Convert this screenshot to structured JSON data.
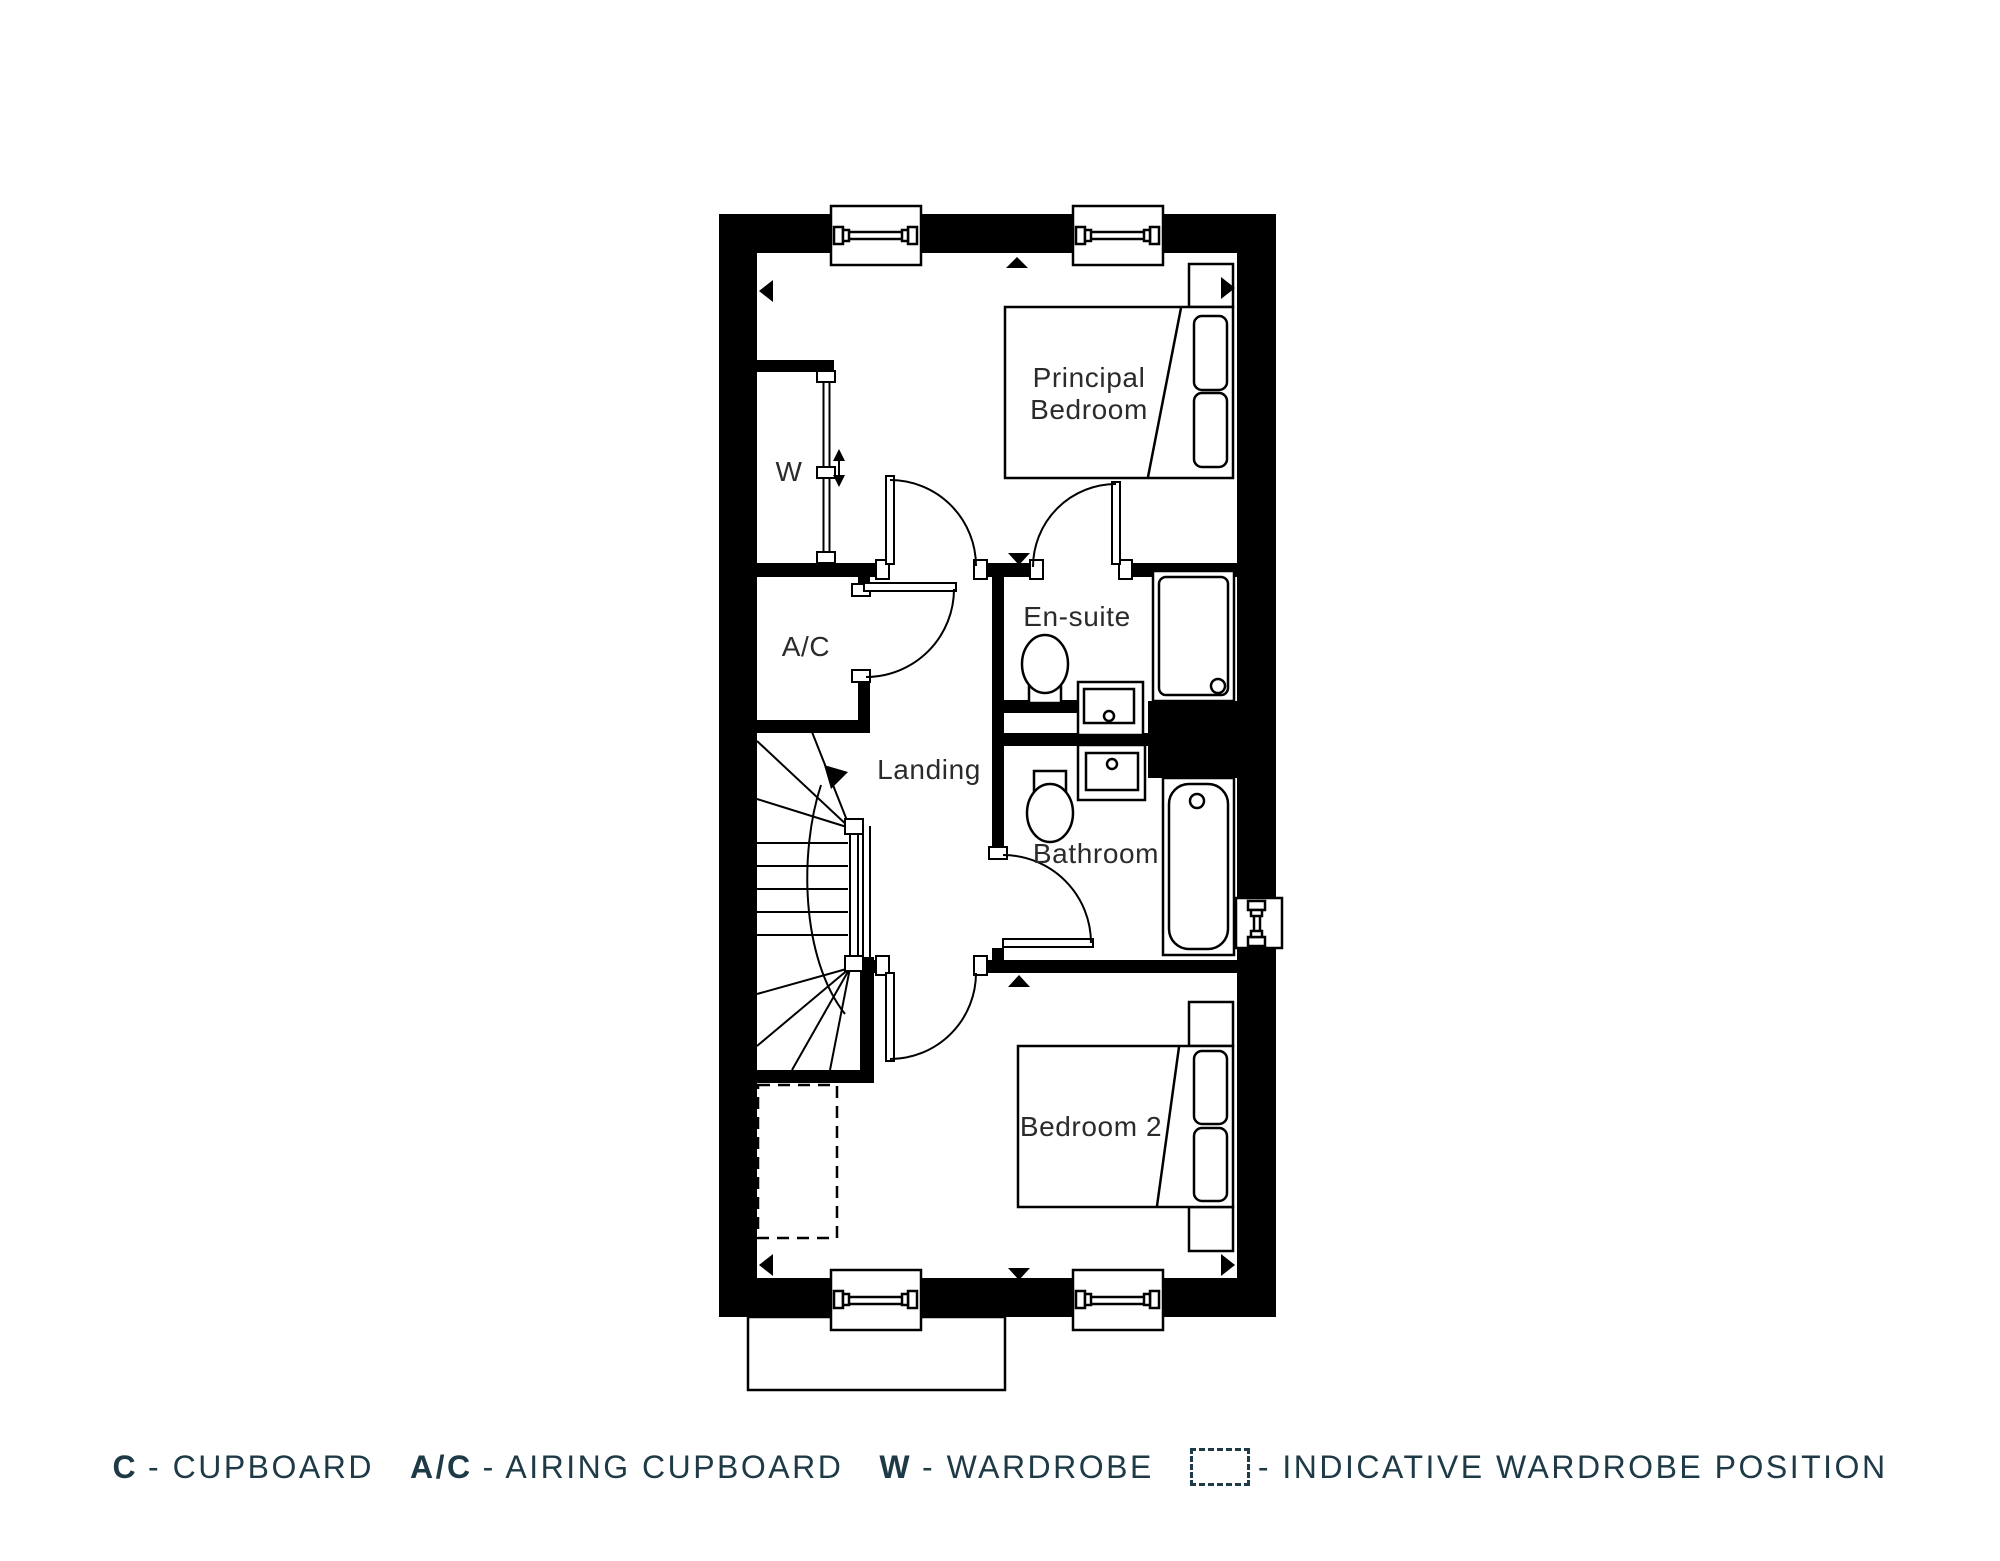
{
  "plan": {
    "floor_name": "First Floor",
    "rooms": {
      "principal_bedroom": {
        "line1": "Principal",
        "line2": "Bedroom"
      },
      "ensuite": "En-suite",
      "landing": "Landing",
      "bathroom": "Bathroom",
      "bedroom2": "Bedroom 2",
      "wardrobe": "W",
      "airing_cupboard": "A/C"
    }
  },
  "legend": {
    "items": [
      {
        "key": "C",
        "label": "- CUPBOARD"
      },
      {
        "key": "A/C",
        "label": "- AIRING CUPBOARD"
      },
      {
        "key": "W",
        "label": "- WARDROBE"
      },
      {
        "key": "",
        "swatch": "dashed-box",
        "label": "- INDICATIVE WARDROBE POSITION"
      }
    ]
  },
  "colors": {
    "line": "#000000",
    "room_label": "#2b2b2b",
    "legend_text": "#1e3a46",
    "background": "#ffffff"
  }
}
